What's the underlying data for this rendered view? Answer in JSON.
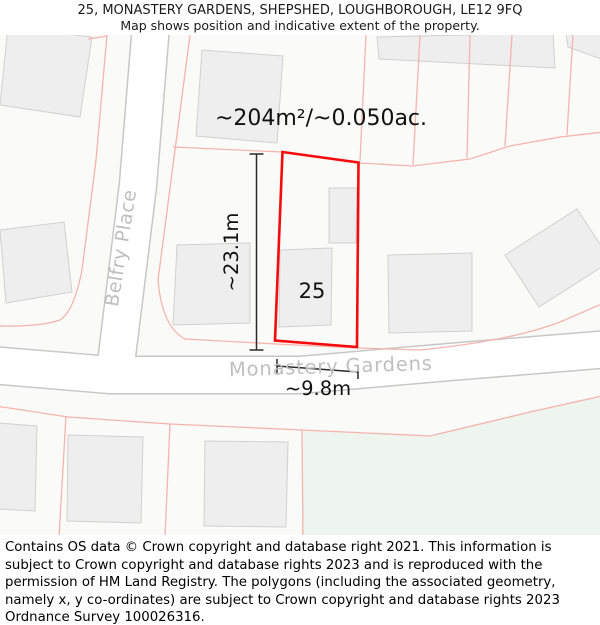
{
  "header": {
    "title": "25, MONASTERY GARDENS, SHEPSHED, LOUGHBOROUGH, LE12 9FQ",
    "subtitle": "Map shows position and indicative extent of the property."
  },
  "map": {
    "area_label": "~204m²/~0.050ac.",
    "property_number": "25",
    "height_label": "~23.1m",
    "width_label": "~9.8m",
    "streets": {
      "belfry": "Belfry Place",
      "monastery": "Monastery Gardens"
    }
  },
  "colors": {
    "property_red": "#f40b0b",
    "parcel_pink": "#f5b3af",
    "open_space_green": "#eef4ee",
    "street_label_gray": "#bfbfbf",
    "measure_black": "#2a2a2a"
  },
  "footer": {
    "text": "Contains OS data © Crown copyright and database right 2021. This information is subject to Crown copyright and database rights 2023 and is reproduced with the permission of HM Land Registry. The polygons (including the associated geometry, namely x, y co-ordinates) are subject to Crown copyright and database rights 2023 Ordnance Survey 100026316."
  }
}
